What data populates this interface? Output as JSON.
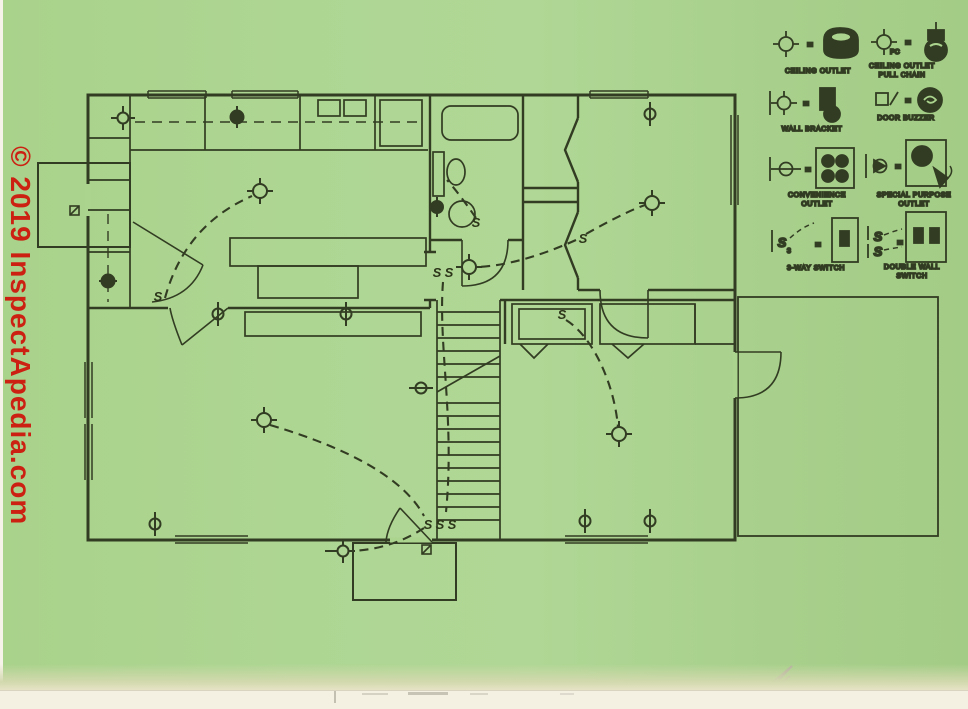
{
  "watermark": {
    "text": "© 2019 InspectApedia.com",
    "color": "#cc2012"
  },
  "colors": {
    "page_green": "#abd48e",
    "ink": "#323c22",
    "paper_edge": "#f4f1e3",
    "watermark_red": "#cc2012"
  },
  "symbols": {
    "eq": "=",
    "s": "S",
    "pc": "PC",
    "three": "3"
  },
  "legend": {
    "items": [
      {
        "name": "ceiling-outlet",
        "l1": "CEILING OUTLET",
        "l2": ""
      },
      {
        "name": "ceiling-outlet-pull-chain",
        "l1": "CEILING OUTLET",
        "l2": "PULL CHAIN"
      },
      {
        "name": "wall-bracket",
        "l1": "WALL BRACKET",
        "l2": ""
      },
      {
        "name": "door-buzzer",
        "l1": "DOOR BUZZER",
        "l2": ""
      },
      {
        "name": "convenience-outlet",
        "l1": "CONVENIENCE",
        "l2": "OUTLET"
      },
      {
        "name": "special-purpose-outlet",
        "l1": "SPECIAL PURPOSE",
        "l2": "OUTLET"
      },
      {
        "name": "three-way-switch",
        "l1": "3-WAY SWITCH",
        "l2": ""
      },
      {
        "name": "double-wall-switch",
        "l1": "DOUBLE WALL",
        "l2": "SWITCH"
      }
    ]
  }
}
